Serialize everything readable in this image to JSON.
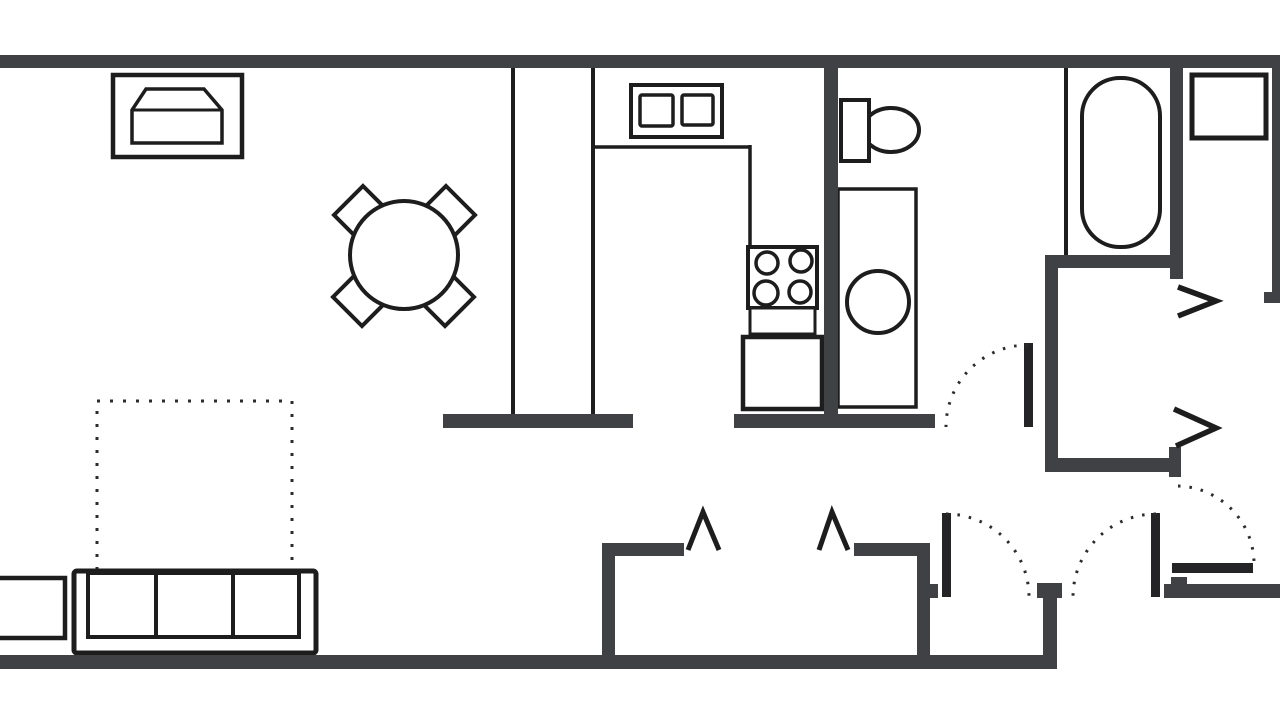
{
  "page": {
    "background": "#ffffff"
  },
  "floor_plan": {
    "canvas": {
      "width": 1280,
      "height": 720
    },
    "colors": {
      "wall": "#3f4145",
      "line": "#1d1d1d",
      "leaf": "#242426",
      "dot": "#2b2b2b",
      "fill": "#ffffff"
    },
    "shapes": [
      {
        "kind": "dotted",
        "name": "rug-outline-dotted",
        "d": "M97,570 L97,401 L292,401 L292,570",
        "sw": 3,
        "dash": "3 10"
      },
      {
        "kind": "rect",
        "name": "tv-cabinet",
        "x": 113,
        "y": 75,
        "w": 129,
        "h": 82,
        "sw": 4.5
      },
      {
        "kind": "polygon",
        "name": "tv-set",
        "points": "132,143 132,110 146,89 204,89 222,110 222,143",
        "sw": 3.5
      },
      {
        "kind": "line",
        "name": "tv-screen-line",
        "x1": 132,
        "y1": 110,
        "x2": 222,
        "y2": 110,
        "sw": 3
      },
      {
        "kind": "polygon",
        "name": "dining-chair-nw",
        "points": "363,186 392,215 363,244 334,215",
        "sw": 4
      },
      {
        "kind": "polygon",
        "name": "dining-chair-ne",
        "points": "446,186 475,215 446,244 417,215",
        "sw": 4
      },
      {
        "kind": "polygon",
        "name": "dining-chair-sw",
        "points": "362,268 391,297 362,326 333,297",
        "sw": 4
      },
      {
        "kind": "polygon",
        "name": "dining-chair-se",
        "points": "445,268 474,297 445,326 416,297",
        "sw": 4
      },
      {
        "kind": "circle",
        "name": "dining-table",
        "cx": 404,
        "cy": 255,
        "r": 54,
        "sw": 4
      },
      {
        "kind": "line",
        "name": "partition-wall-left",
        "x1": 513,
        "y1": 62,
        "x2": 513,
        "y2": 415,
        "sw": 4
      },
      {
        "kind": "line",
        "name": "partition-wall-right",
        "x1": 593,
        "y1": 62,
        "x2": 593,
        "y2": 415,
        "sw": 4
      },
      {
        "kind": "line",
        "name": "kitchen-counter-edge-top",
        "x1": 593,
        "y1": 147,
        "x2": 750,
        "y2": 147,
        "sw": 3.5
      },
      {
        "kind": "line",
        "name": "kitchen-counter-edge-side",
        "x1": 750,
        "y1": 145,
        "x2": 750,
        "y2": 249,
        "sw": 3.5
      },
      {
        "kind": "rect",
        "name": "kitchen-sink-unit",
        "x": 631,
        "y": 85,
        "w": 91,
        "h": 52,
        "sw": 4
      },
      {
        "kind": "rect",
        "name": "kitchen-sink-basin-left",
        "x": 640,
        "y": 95,
        "w": 33,
        "h": 31,
        "rx": 2,
        "sw": 3.5
      },
      {
        "kind": "rect",
        "name": "kitchen-sink-basin-right",
        "x": 682,
        "y": 95,
        "w": 31,
        "h": 30,
        "rx": 2,
        "sw": 3.5
      },
      {
        "kind": "rect",
        "name": "stove",
        "x": 748,
        "y": 247,
        "w": 69,
        "h": 61,
        "sw": 4
      },
      {
        "kind": "circle",
        "name": "stove-burner-tl",
        "cx": 767,
        "cy": 263,
        "r": 11,
        "sw": 3.5
      },
      {
        "kind": "circle",
        "name": "stove-burner-tr",
        "cx": 801,
        "cy": 261,
        "r": 11,
        "sw": 3.5
      },
      {
        "kind": "circle",
        "name": "stove-burner-bl",
        "cx": 766,
        "cy": 293,
        "r": 12,
        "sw": 3.5
      },
      {
        "kind": "circle",
        "name": "stove-burner-br",
        "cx": 800,
        "cy": 292,
        "r": 11,
        "sw": 3.5
      },
      {
        "kind": "rect",
        "name": "stove-base",
        "x": 750,
        "y": 308,
        "w": 65,
        "h": 26,
        "sw": 3
      },
      {
        "kind": "rect",
        "name": "kitchen-cabinet",
        "x": 743,
        "y": 337,
        "w": 79,
        "h": 72,
        "sw": 4.5
      },
      {
        "kind": "rect",
        "name": "side-table",
        "x": -8,
        "y": 578,
        "w": 73,
        "h": 60,
        "sw": 4.5
      },
      {
        "kind": "rect",
        "name": "sofa-body",
        "x": 74,
        "y": 571,
        "w": 242,
        "h": 82,
        "rx": 3,
        "sw": 5
      },
      {
        "kind": "rect",
        "name": "sofa-cushion-left",
        "x": 88,
        "y": 573,
        "w": 68,
        "h": 64,
        "sw": 4
      },
      {
        "kind": "rect",
        "name": "sofa-cushion-middle",
        "x": 156,
        "y": 573,
        "w": 77,
        "h": 64,
        "sw": 4
      },
      {
        "kind": "rect",
        "name": "sofa-cushion-right",
        "x": 233,
        "y": 573,
        "w": 66,
        "h": 64,
        "sw": 4
      },
      {
        "kind": "ellipse",
        "name": "toilet-bowl",
        "cx": 891,
        "cy": 130,
        "rx": 28,
        "ry": 22,
        "sw": 4
      },
      {
        "kind": "rect",
        "name": "toilet-tank",
        "x": 841,
        "y": 100,
        "w": 28,
        "h": 61,
        "sw": 4
      },
      {
        "kind": "rect",
        "name": "washer-closet",
        "x": 838,
        "y": 189,
        "w": 78,
        "h": 218,
        "sw": 3.5
      },
      {
        "kind": "circle",
        "name": "washer",
        "cx": 878,
        "cy": 302,
        "r": 31,
        "sw": 4
      },
      {
        "kind": "line",
        "name": "tub-room-partition",
        "x1": 1066,
        "y1": 62,
        "x2": 1066,
        "y2": 258,
        "sw": 4
      },
      {
        "kind": "rect",
        "name": "bathtub",
        "x": 1082,
        "y": 78,
        "w": 78,
        "h": 169,
        "rx": 38,
        "sw": 4
      },
      {
        "kind": "rect",
        "name": "bathroom-sink",
        "x": 1192,
        "y": 75,
        "w": 74,
        "h": 63,
        "sw": 5
      },
      {
        "kind": "wall",
        "name": "top-wall",
        "x": 0,
        "y": 55,
        "w": 1280,
        "h": 13
      },
      {
        "kind": "wall",
        "name": "bottom-wall",
        "x": 0,
        "y": 655,
        "w": 1057,
        "h": 14
      },
      {
        "kind": "wall",
        "name": "kitchen-bath-wall",
        "x": 824,
        "y": 62,
        "w": 14,
        "h": 366
      },
      {
        "kind": "wall",
        "name": "bath-bottom-wall",
        "x": 734,
        "y": 414,
        "w": 201,
        "h": 14
      },
      {
        "kind": "wall",
        "name": "counter-base-wall",
        "x": 443,
        "y": 414,
        "w": 190,
        "h": 14
      },
      {
        "kind": "wall",
        "name": "closet-left-wall",
        "x": 602,
        "y": 543,
        "w": 13,
        "h": 126
      },
      {
        "kind": "wall",
        "name": "closet-top-left-wall",
        "x": 602,
        "y": 543,
        "w": 82,
        "h": 13
      },
      {
        "kind": "wall",
        "name": "closet-top-right-wall",
        "x": 854,
        "y": 543,
        "w": 76,
        "h": 13
      },
      {
        "kind": "wall",
        "name": "closet-right-wall",
        "x": 917,
        "y": 543,
        "w": 13,
        "h": 126
      },
      {
        "kind": "wall",
        "name": "closet-door-stop",
        "x": 929,
        "y": 584,
        "w": 9,
        "h": 14
      },
      {
        "kind": "wall",
        "name": "bedroom-center-stub",
        "x": 1037,
        "y": 583,
        "w": 25,
        "h": 15
      },
      {
        "kind": "wall",
        "name": "bedroom-left-wall",
        "x": 1043,
        "y": 597,
        "w": 14,
        "h": 72
      },
      {
        "kind": "wall",
        "name": "hall-left-wall",
        "x": 1045,
        "y": 255,
        "w": 13,
        "h": 217
      },
      {
        "kind": "wall",
        "name": "hall-top-wall",
        "x": 1045,
        "y": 255,
        "w": 135,
        "h": 13
      },
      {
        "kind": "wall",
        "name": "hall-bottom-wall",
        "x": 1045,
        "y": 458,
        "w": 136,
        "h": 14
      },
      {
        "kind": "wall",
        "name": "hall-bottom-wall-end",
        "x": 1169,
        "y": 447,
        "w": 12,
        "h": 30
      },
      {
        "kind": "wall",
        "name": "right-closet-wall",
        "x": 1170,
        "y": 62,
        "w": 13,
        "h": 217
      },
      {
        "kind": "wall",
        "name": "right-edge-wall",
        "x": 1272,
        "y": 60,
        "w": 8,
        "h": 243
      },
      {
        "kind": "wall",
        "name": "right-edge-foot",
        "x": 1264,
        "y": 292,
        "w": 16,
        "h": 11
      },
      {
        "kind": "wall",
        "name": "right-door-wall",
        "x": 1164,
        "y": 584,
        "w": 116,
        "h": 14
      },
      {
        "kind": "wall",
        "name": "right-door-hinge",
        "x": 1171,
        "y": 577,
        "w": 16,
        "h": 16
      },
      {
        "kind": "chevron",
        "name": "bifold-door-closet-left",
        "points": "688,550 703,512 719,550",
        "sw": 5
      },
      {
        "kind": "chevron",
        "name": "bifold-door-closet-right",
        "points": "819,550 832,512 848,550",
        "sw": 5
      },
      {
        "kind": "chevron",
        "name": "bifold-door-right-upper",
        "points": "1178,287 1216,301 1178,316",
        "sw": 5.5
      },
      {
        "kind": "chevron",
        "name": "bifold-door-right-lower",
        "points": "1174,409 1216,428 1176,446",
        "sw": 5.5
      },
      {
        "kind": "leaf",
        "name": "bath-door-leaf",
        "x": 1024,
        "y": 343,
        "w": 9,
        "h": 84
      },
      {
        "kind": "leaf",
        "name": "double-door-leaf-left",
        "x": 942,
        "y": 513,
        "w": 9,
        "h": 84
      },
      {
        "kind": "leaf",
        "name": "double-door-leaf-right",
        "x": 1151,
        "y": 513,
        "w": 9,
        "h": 84
      },
      {
        "kind": "leaf",
        "name": "right-door-leaf",
        "x": 1172,
        "y": 563,
        "w": 81,
        "h": 10
      },
      {
        "kind": "dotted",
        "name": "bath-door-swing-arc",
        "d": "M1028,345 A82,82 0 0 0 946,427",
        "sw": 3,
        "dash": "2.5 9"
      },
      {
        "kind": "dotted",
        "name": "double-door-swing-arc-left",
        "d": "M946,514 A83,83 0 0 1 1029,597",
        "sw": 3,
        "dash": "2.5 9"
      },
      {
        "kind": "dotted",
        "name": "double-door-swing-arc-right",
        "d": "M1156,514 A83,83 0 0 0 1073,597",
        "sw": 3,
        "dash": "2.5 9"
      },
      {
        "kind": "dotted",
        "name": "right-door-swing-arc",
        "d": "M1178,486 A78,78 0 0 1 1254,562",
        "sw": 3,
        "dash": "2.5 9"
      }
    ]
  }
}
